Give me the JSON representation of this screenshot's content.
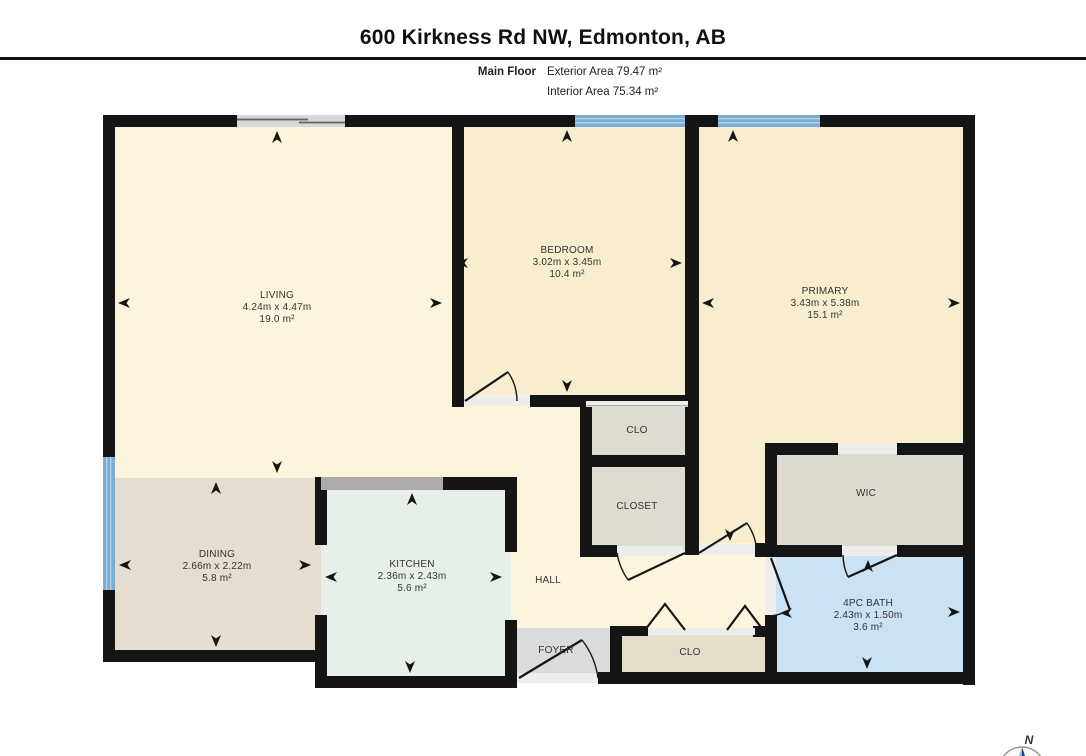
{
  "header": {
    "title": "600 Kirkness Rd NW, Edmonton, AB",
    "floor_label": "Main Floor",
    "exterior_area": "Exterior Area 79.47 m²",
    "interior_area": "Interior Area 75.34 m²"
  },
  "rooms": {
    "living": {
      "name": "LIVING",
      "dimensions": "4.24m x 4.47m",
      "area": "19.0 m²"
    },
    "dining": {
      "name": "DINING",
      "dimensions": "2.66m x 2.22m",
      "area": "5.8 m²"
    },
    "kitchen": {
      "name": "KITCHEN",
      "dimensions": "2.36m x 2.43m",
      "area": "5.6 m²"
    },
    "bedroom": {
      "name": "BEDROOM",
      "dimensions": "3.02m x 3.45m",
      "area": "10.4 m²"
    },
    "primary": {
      "name": "PRIMARY",
      "dimensions": "3.43m x 5.38m",
      "area": "15.1 m²"
    },
    "bath": {
      "name": "4PC BATH",
      "dimensions": "2.43m x 1.50m",
      "area": "3.6 m²"
    },
    "hall": {
      "name": "HALL"
    },
    "foyer": {
      "name": "FOYER"
    },
    "bedroom_closet": {
      "name": "CLO"
    },
    "hall_closet": {
      "name": "CLOSET"
    },
    "entry_closet": {
      "name": "CLO"
    },
    "wic": {
      "name": "WIC"
    }
  },
  "compass": {
    "north_label": "N"
  },
  "colors": {
    "wall": "#151515",
    "living_hall": "#FCF4DC",
    "bedrooms": "#F8EDCF",
    "dining": "#E4DDD0",
    "kitchen": "#E7EFE9",
    "closets": "#E0DBD1",
    "entry_closet": "#E5DDCB",
    "wic": "#DFDACF",
    "bath": "#CBE2F4",
    "foyer": "#DBDBDB",
    "window_blue": "#79AED6",
    "window_gray": "#D8D8D8",
    "threshold": "#EDEDED",
    "counter_gray": "#ABABAB"
  }
}
